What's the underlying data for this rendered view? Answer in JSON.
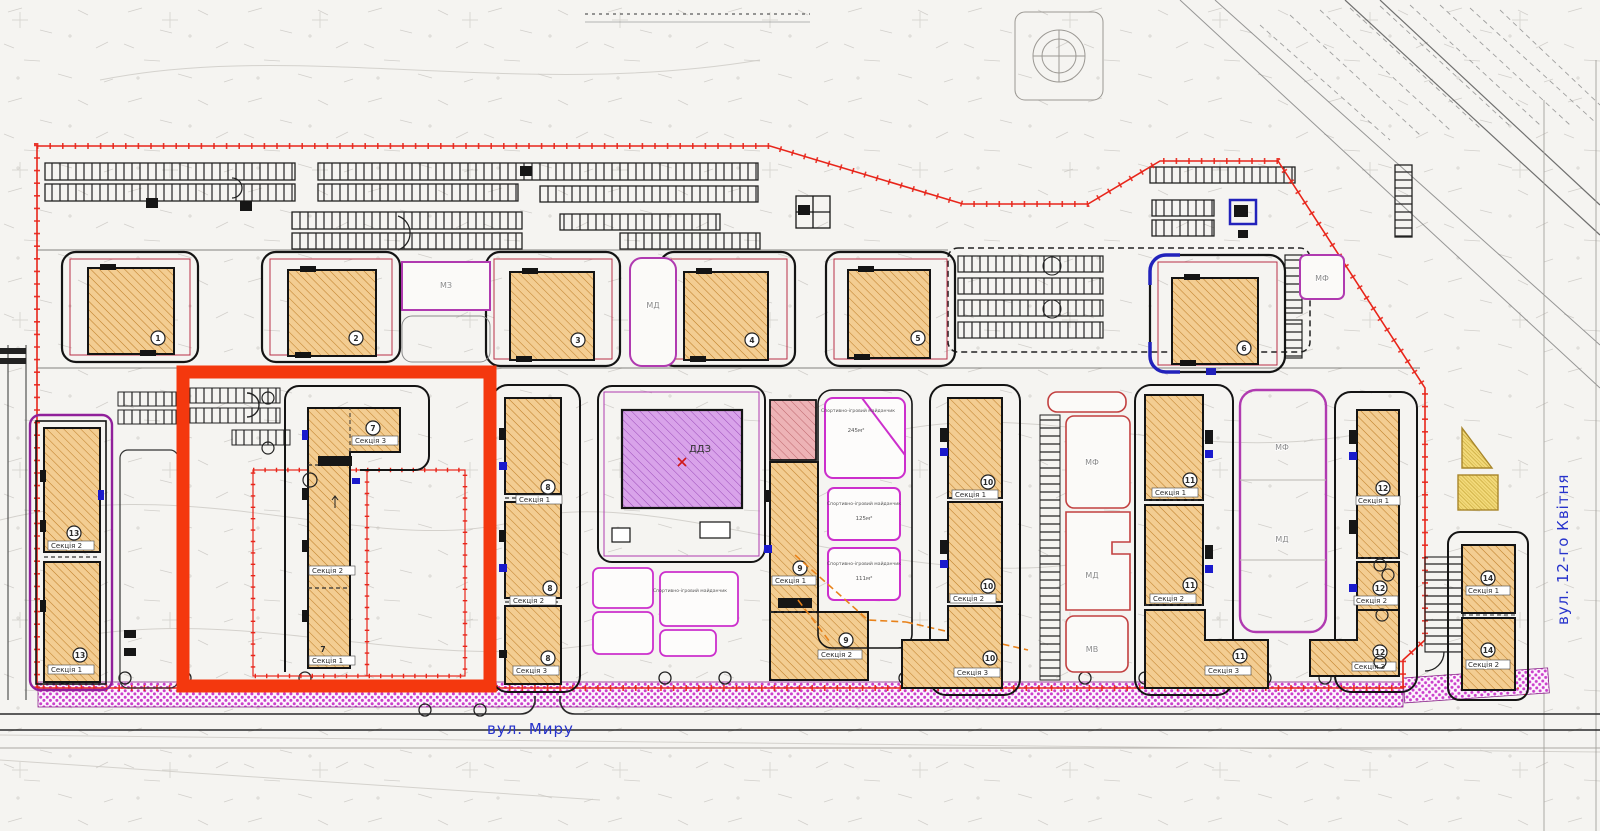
{
  "title": "Генеральний план житлового кварталу",
  "colors": {
    "boundary_red": "#e8251a",
    "highlight_orange_red": "#f4380e",
    "building_fill": "#f3cd92",
    "building_hatch": "#c0802a",
    "kindergarten_fill": "#d9a3ea",
    "playground_magenta": "#cc2fcc",
    "boulevard_magenta": "#cb3fcb",
    "street_text_blue": "#2733cc",
    "entrance_blue": "#1a1acc",
    "yellow_plot": "#f3da7a"
  },
  "streets": {
    "bottom": "вул. Миру",
    "right": "вул. 12-го Квітня"
  },
  "kindergarten": {
    "label": "ДДЗ"
  },
  "plots": {
    "mf": "МФ",
    "md": "МД",
    "mv": "МВ",
    "mz": "МЗ"
  },
  "top_row": {
    "b1": "1",
    "b2": "2",
    "b3": "3",
    "b4": "4",
    "b5": "5",
    "b6": "6"
  },
  "b7": {
    "num": "7",
    "s1": "Секція 1",
    "s2": "Секція 2",
    "s3": "Секція 3"
  },
  "b8": {
    "num": "8",
    "s1": "Секція 1",
    "s2": "Секція 2",
    "s3": "Секція 3"
  },
  "b9": {
    "num": "9",
    "s1": "Секція 1",
    "s2": "Секція 2"
  },
  "b10": {
    "num": "10",
    "s1": "Секція 1",
    "s2": "Секція 2",
    "s3": "Секція 3"
  },
  "b11": {
    "num": "11",
    "s1": "Секція 1",
    "s2": "Секція 2",
    "s3": "Секція 3"
  },
  "b12": {
    "num": "12",
    "s1": "Секція 1",
    "s2": "Секція 2",
    "s3": "Секція 3"
  },
  "b13": {
    "num": "13",
    "s1": "Секція 1",
    "s2": "Секція 2"
  },
  "b14": {
    "num": "14",
    "s1": "Секція 1",
    "s2": "Секція 2"
  },
  "playgrounds": {
    "label": "Спортивно-ігровий майданчик",
    "area_top": "245м²",
    "area_mid": "125м²",
    "area_low": "111м²"
  }
}
